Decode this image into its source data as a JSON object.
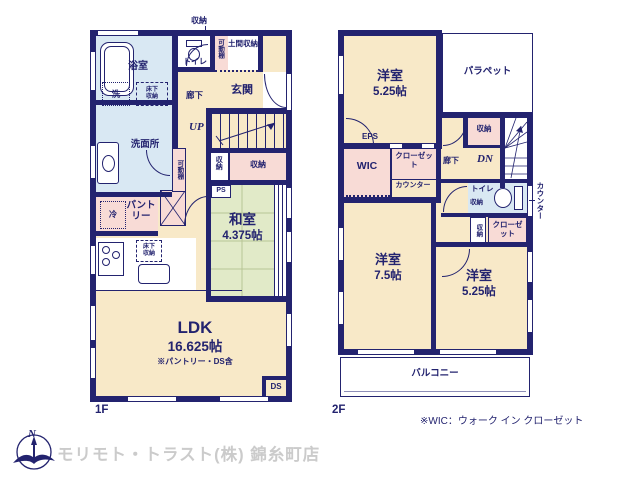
{
  "colors": {
    "wall": "#23236f",
    "room_cream": "#f8e9c8",
    "room_pink": "#f8dbd6",
    "room_green": "#e1eac8",
    "room_blue": "#d9e8f3",
    "tatami_line": "#b7c596",
    "watermark_gray": "#cbcbcb"
  },
  "f1": {
    "floor": "1F",
    "bathroom": "浴室",
    "wash": "洗",
    "underfloor_a": "床下収納",
    "washroom": "洗面所",
    "toilet": "トイレ",
    "storage_top": "収納",
    "shelf_a": "可動棚",
    "doma": "土間収納",
    "entrance": "玄関",
    "hallway": "廊下",
    "up": "UP",
    "storage_a": "収納",
    "storage_b": "収納",
    "ps": "PS",
    "washitsu": "和室",
    "washitsu_size": "4.375帖",
    "shelf_b": "可動棚",
    "fridge": "冷",
    "pantry": "パントリー",
    "underfloor_b": "床下収納",
    "ldk": "LDK",
    "ldk_size": "16.625帖",
    "ldk_note": "※パントリー・DS含",
    "ds": "DS"
  },
  "f2": {
    "floor": "2F",
    "bedroom_a": "洋室",
    "bedroom_a_size": "5.25帖",
    "parapet": "パラペット",
    "eps": "EPS",
    "wic": "WIC",
    "closet_a": "クローゼット",
    "counter_a": "カウンター",
    "hallway": "廊下",
    "dn": "DN",
    "storage_hall": "収納",
    "toilet": "トイレ",
    "storage_toilet": "収納",
    "counter_b": "カウンター",
    "storage_side": "収納",
    "closet_b": "クローゼット",
    "bedroom_b": "洋室",
    "bedroom_b_size": "7.5帖",
    "bedroom_c": "洋室",
    "bedroom_c_size": "5.25帖",
    "balcony": "バルコニー"
  },
  "footer": {
    "north": "N",
    "watermark": "モリモト・トラスト(株) 錦糸町店",
    "wic_note": "※WIC：ウォーク イン クローゼット"
  }
}
